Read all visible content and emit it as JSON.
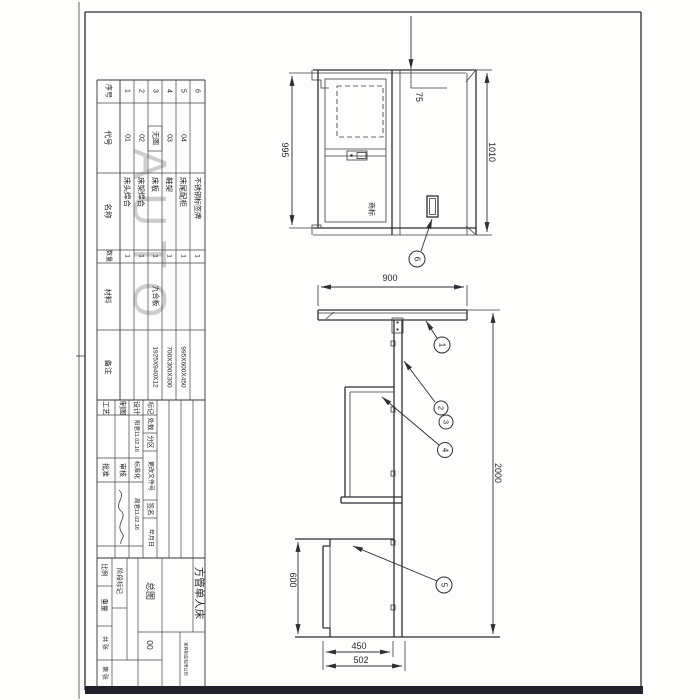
{
  "sheet": {
    "watermark": "AUTO"
  },
  "parts_table": {
    "headers": [
      "序号",
      "代号",
      "名称",
      "数量",
      "材料",
      "备注"
    ],
    "rows": [
      {
        "no": "1",
        "code": "01",
        "name": "床头焊合",
        "qty": "1",
        "material": "",
        "remark": ""
      },
      {
        "no": "2",
        "code": "02",
        "name": "床架焊合",
        "qty": "1",
        "material": "",
        "remark": ""
      },
      {
        "no": "3",
        "code": "无图",
        "name": "床板",
        "qty": "1",
        "material": "九合板",
        "remark": "1925X940X12"
      },
      {
        "no": "4",
        "code": "03",
        "name": "鞋架",
        "qty": "1",
        "material": "",
        "remark": "700X300X300"
      },
      {
        "no": "5",
        "code": "04",
        "name": "床尾配柜",
        "qty": "1",
        "material": "",
        "remark": "995X600X450"
      },
      {
        "no": "6",
        "code": "",
        "name": "不锈钢标签牌",
        "qty": "1",
        "material": "",
        "remark": ""
      }
    ]
  },
  "title_block": {
    "rev": [
      "标记",
      "处数",
      "分区",
      "更改文件号",
      "签名",
      "年月日"
    ],
    "design_label": "设计",
    "design_sig": "阳君11.02.16",
    "std_label": "标准化",
    "std_sig": "周君11.02.16",
    "draft_label": "制图",
    "check_label": "审核",
    "process_label": "工艺",
    "approve_label": "批准",
    "stage_label": "阶段标记",
    "weight_label": "重量",
    "scale_label": "比例",
    "sheets_label": "共 张",
    "page_label": "第 张",
    "doc_type": "总图",
    "drawing_no": "00",
    "title": "方管单人床",
    "company": "家具制造有限公司"
  },
  "dims": {
    "v75": "75",
    "v995": "995",
    "v1010": "1010",
    "v900": "900",
    "v2000": "2000",
    "v600": "600",
    "v450": "450",
    "v502": "502",
    "brand": "商标"
  },
  "callouts": {
    "n1": "1",
    "n2": "2",
    "n3": "3",
    "n4": "4",
    "n5": "5",
    "n6": "6"
  }
}
